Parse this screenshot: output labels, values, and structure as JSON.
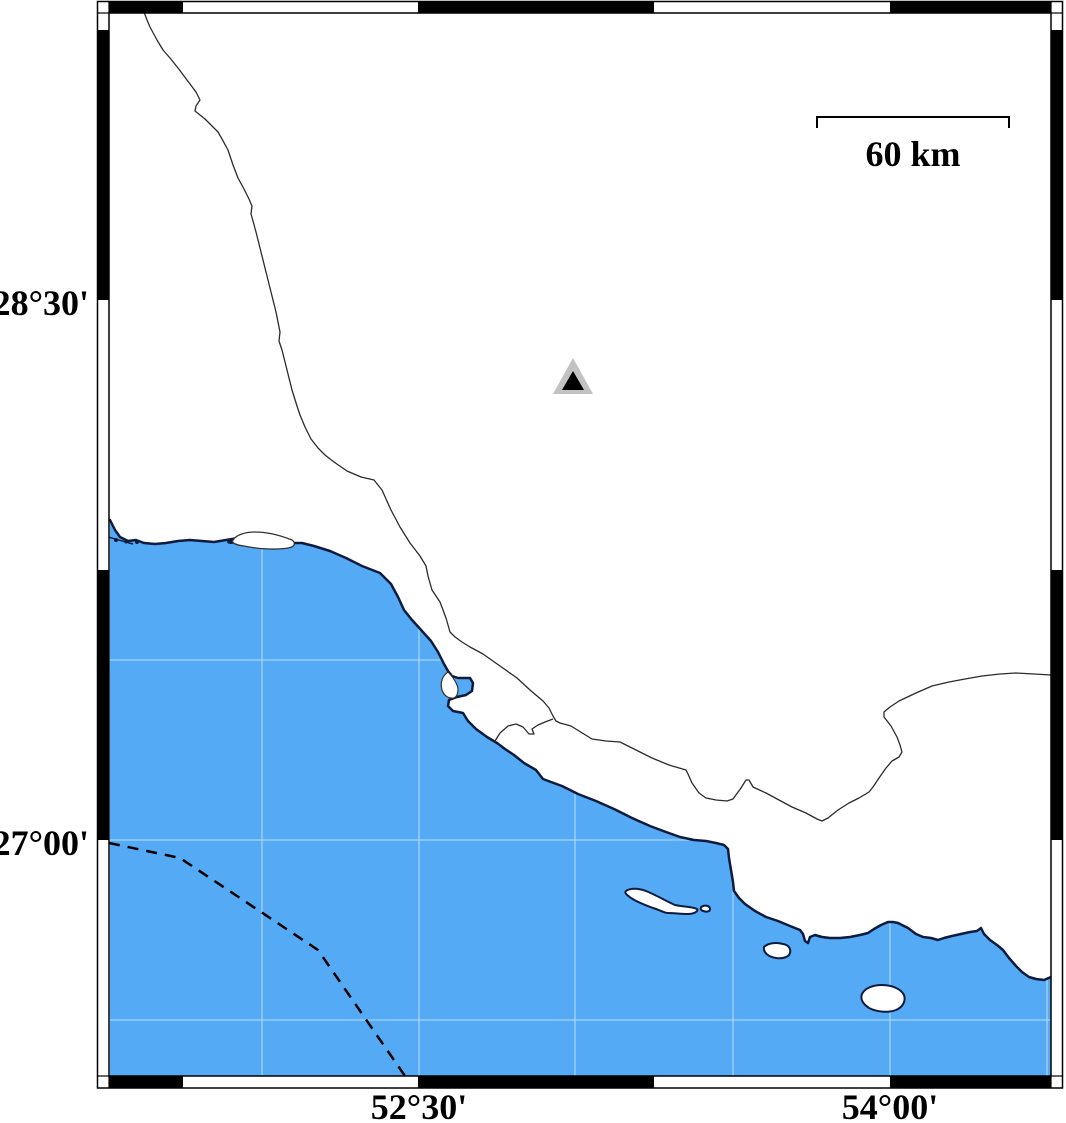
{
  "map": {
    "axis": {
      "lat_labels": [
        "28°30'",
        "27°00'"
      ],
      "lon_labels": [
        "52°30'",
        "54°00'"
      ]
    },
    "scale_bar": {
      "label": "60 km"
    },
    "marker": {
      "symbol": "filled-triangle-with-gray-halo"
    },
    "features": {
      "coastline": "persian-gulf-coast",
      "islands_count": 4,
      "boundary_line": "thin-inland-administrative-boundary",
      "maritime_line": "dashed-offshore-boundary"
    },
    "colors": {
      "sea": "#55aaf5",
      "land": "#ffffff",
      "coast_stroke": "#0d1b3e",
      "boundary_stroke": "#2b2b2b",
      "dashed_line": "#000000",
      "frame_black": "#000000",
      "marker_outer_gray": "#c2c2c2",
      "marker_inner": "#000000",
      "gridline": "#ffffff"
    }
  }
}
